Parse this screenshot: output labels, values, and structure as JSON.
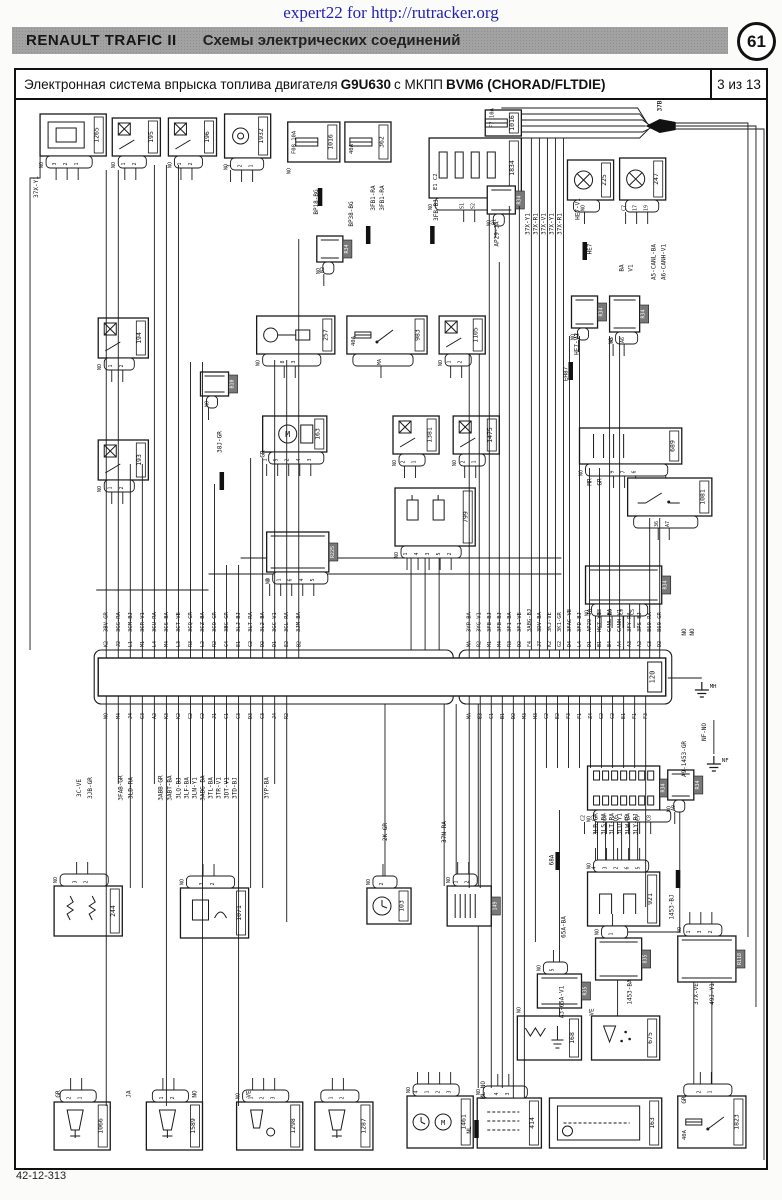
{
  "page": {
    "watermark": "expert22 for http://rutracker.org",
    "header": {
      "brand": "RENAULT  TRAFIC II",
      "title": "Схемы электрических соединений",
      "page_circle": "61"
    },
    "diagram_title": {
      "prefix": "Электронная система впрыска топлива двигателя",
      "engine": "G9U630",
      "middle": "с МКПП",
      "gearbox": "BVM6 (CHORAD/FLTDIE)",
      "page_of": "3 из 13"
    },
    "footer_code": "42-12-313"
  },
  "diagram": {
    "ecu": {
      "id": "120",
      "body": {
        "x": 98,
        "y": 656,
        "w": 566,
        "h": 38
      },
      "shrouds": [
        [
          94,
          648,
          358,
          54
        ],
        [
          458,
          648,
          212,
          54
        ]
      ],
      "label_box": {
        "x": 646,
        "y": 660,
        "w": 14,
        "h": 30
      },
      "top": {
        "x0": 106,
        "dx": 12,
        "pins": [
          "K2",
          "J2",
          "L1",
          "M1",
          "L4",
          "M4",
          "L3",
          "R3",
          "L2",
          "R2",
          "C4",
          "E1",
          "C2",
          "D2",
          "D1",
          "E2",
          "B2"
        ],
        "labels": [
          "3BV-GR",
          "3GG-RA",
          "3CM-BJ",
          "3CR-V1",
          "3CU-RA",
          "3CS-BA",
          "3CT-VE",
          "3CQ-GR",
          "3CZ-BA",
          "3CO-GR",
          "3BG-GR",
          "3LJ-BJ",
          "3LT-RA",
          "3L2-BA",
          "3GC-V1",
          "3CL-RA",
          "3JM-BA"
        ],
        "up": [
          168,
          168,
          462,
          462,
          163,
          163,
          163,
          360,
          360,
          482,
          563,
          563,
          456,
          456,
          358,
          358,
          237
        ]
      },
      "top2": {
        "x0": 468,
        "dx": 10,
        "pins": [
          "MA",
          "R2",
          "M1",
          "M4",
          "R3",
          "D2",
          "F4",
          "J7",
          "K2",
          "G2",
          "D4",
          "L4",
          "D1",
          "B1",
          "B4",
          "A4",
          "A3",
          "A2",
          "C3",
          "D2"
        ],
        "labels": [
          "3YP-BA",
          "3YG-V1",
          "3FB-BJ",
          "3FB-BJ",
          "3F1-BA",
          "3F1-VE",
          "3ABG-BJ",
          "3DV-BA",
          "3KJ-VE",
          "3K1-GR",
          "3FAC-VE",
          "3FD-BJ",
          "AP29-JA",
          "HK7-Y1",
          "CANL-BA",
          "CANH-V1",
          "3FY-RA",
          "3PS-BJ",
          "869-RA",
          "869-GR"
        ],
        "up": [
          352,
          352,
          212,
          260,
          204,
          204,
          648,
          648,
          648,
          648,
          334,
          334,
          466,
          466,
          334,
          334,
          602,
          602,
          516,
          516
        ]
      },
      "bot": {
        "x0": 106,
        "dx": 12,
        "pins": [
          "NO",
          "M4",
          "J4",
          "G3",
          "A2",
          "K3",
          "K2",
          "G2",
          "C2",
          "J1",
          "C1",
          "C3",
          "D3",
          "C3",
          "J4",
          "R2"
        ],
        "down": [
          1104,
          782,
          886,
          886,
          782,
          1104,
          782,
          782,
          1104,
          782,
          782,
          1104,
          886,
          886,
          782,
          920
        ]
      },
      "bot2": {
        "x0": 468,
        "dx": 11,
        "pins": [
          "MA",
          "E3",
          "C1",
          "B1",
          "D2",
          "M3",
          "H3",
          "C2",
          "E2",
          "F3",
          "F1",
          "Z4",
          "G2",
          "C2",
          "E1",
          "F1",
          "F3"
        ],
        "down": [
          886,
          886,
          1086,
          1086,
          1096,
          1096,
          940,
          766,
          766,
          766,
          766,
          766,
          766,
          766,
          766,
          766,
          905
        ]
      }
    },
    "components": [
      {
        "id": "1265",
        "x": 40,
        "y": 112,
        "w": 66,
        "h": 42,
        "ic": "sensorBlock",
        "pins": [
          "3",
          "2",
          "1"
        ],
        "no": true
      },
      {
        "id": "195",
        "x": 112,
        "y": 116,
        "w": 48,
        "h": 38,
        "ic": "relay",
        "pins": [
          "1",
          "2"
        ],
        "no": true
      },
      {
        "id": "196",
        "x": 168,
        "y": 116,
        "w": 48,
        "h": 38,
        "ic": "relay",
        "pins": [
          "1",
          "2"
        ],
        "no": true
      },
      {
        "id": "1932",
        "x": 224,
        "y": 112,
        "w": 46,
        "h": 44,
        "ic": "pump",
        "pins": [
          "3",
          "2",
          "1"
        ],
        "no": true
      },
      {
        "id": "1016",
        "x": 287,
        "y": 120,
        "w": 52,
        "h": 40,
        "ic": "fuse",
        "note": "F08 10A",
        "no": true
      },
      {
        "id": "362",
        "x": 344,
        "y": 120,
        "w": 46,
        "h": 40,
        "ic": "fuse",
        "note": "40A"
      },
      {
        "id": "1834",
        "x": 428,
        "y": 136,
        "w": 92,
        "h": 60,
        "ic": "fusebox",
        "pins": [
          "S1",
          "S2"
        ],
        "note": "E1 C2",
        "no": true
      },
      {
        "id": "1016",
        "x": 484,
        "y": 108,
        "w": 36,
        "h": 26,
        "ic": "fuse",
        "note": "F7 10A"
      },
      {
        "id": "225",
        "x": 566,
        "y": 158,
        "w": 46,
        "h": 40,
        "ic": "fan",
        "pins": [
          "NO"
        ]
      },
      {
        "id": "247",
        "x": 618,
        "y": 156,
        "w": 46,
        "h": 42,
        "ic": "fan",
        "pins": [
          "C7",
          "17",
          "19"
        ]
      },
      {
        "id": "R34",
        "x": 486,
        "y": 184,
        "w": 28,
        "h": 28,
        "ic": "inlineV",
        "pins": [
          "B1"
        ],
        "no": true
      },
      {
        "id": "R34",
        "x": 316,
        "y": 234,
        "w": 26,
        "h": 26,
        "ic": "inlineV",
        "pins": [
          "B2"
        ],
        "no": true
      },
      {
        "id": "R34",
        "x": 570,
        "y": 294,
        "w": 26,
        "h": 32,
        "ic": "inlineV",
        "pins": [
          "A7"
        ],
        "no": true
      },
      {
        "id": "R34",
        "x": 608,
        "y": 294,
        "w": 30,
        "h": 36,
        "ic": "inlineV",
        "pins": [
          "A5",
          "A6"
        ],
        "no": true
      },
      {
        "id": "194",
        "x": 98,
        "y": 316,
        "w": 50,
        "h": 40,
        "ic": "relay",
        "pins": [
          "1",
          "2"
        ],
        "no": true
      },
      {
        "id": "193",
        "x": 98,
        "y": 438,
        "w": 50,
        "h": 40,
        "ic": "relay",
        "pins": [
          "1",
          "2"
        ],
        "no": true
      },
      {
        "id": "257",
        "x": 256,
        "y": 314,
        "w": 78,
        "h": 38,
        "ic": "glow",
        "pins": [
          "8",
          "3"
        ],
        "no": true
      },
      {
        "id": "983",
        "x": 346,
        "y": 314,
        "w": 80,
        "h": 38,
        "ic": "fuseSwitch",
        "note": "40A",
        "pins": [
          "MA"
        ]
      },
      {
        "id": "1105",
        "x": 438,
        "y": 314,
        "w": 46,
        "h": 38,
        "ic": "relay",
        "pins": [
          "1",
          "2"
        ],
        "no": true
      },
      {
        "id": "B10",
        "x": 200,
        "y": 370,
        "w": 28,
        "h": 24,
        "ic": "inlineV",
        "pins": [
          "NO"
        ]
      },
      {
        "id": "163",
        "x": 262,
        "y": 414,
        "w": 64,
        "h": 36,
        "ic": "starter",
        "pins": [
          "1",
          "5",
          "2",
          "4",
          "3"
        ]
      },
      {
        "id": "1381",
        "x": 392,
        "y": 414,
        "w": 46,
        "h": 38,
        "ic": "relay",
        "pins": [
          "2",
          "1"
        ],
        "no": true
      },
      {
        "id": "1475",
        "x": 452,
        "y": 414,
        "w": 46,
        "h": 38,
        "ic": "relay",
        "pins": [
          "2",
          "1"
        ],
        "no": true
      },
      {
        "id": "689",
        "x": 578,
        "y": 426,
        "w": 102,
        "h": 36,
        "ic": "comb",
        "pins": [
          "9",
          "7",
          "6"
        ],
        "no": true
      },
      {
        "id": "1081",
        "x": 626,
        "y": 476,
        "w": 84,
        "h": 38,
        "ic": "switch",
        "pins": [
          "36",
          "A7"
        ]
      },
      {
        "id": "799",
        "x": 394,
        "y": 486,
        "w": 80,
        "h": 58,
        "ic": "sol2",
        "pins": [
          "1",
          "4",
          "3",
          "5",
          "2"
        ],
        "no": true
      },
      {
        "id": "R225",
        "x": 266,
        "y": 530,
        "w": 62,
        "h": 40,
        "ic": "inline",
        "pins": [
          "3",
          "1",
          "6",
          "4",
          "5"
        ],
        "no": true
      },
      {
        "id": "R34",
        "x": 584,
        "y": 564,
        "w": 76,
        "h": 38,
        "ic": "inline",
        "pins": [
          "B8",
          "B9",
          "C9",
          "C5"
        ],
        "no": true
      },
      {
        "id": "R34",
        "x": 586,
        "y": 764,
        "w": 72,
        "h": 44,
        "ic": "gridConn",
        "pins": [
          "C2",
          "C3",
          "C4",
          "D5",
          "C5",
          "C7",
          "C8"
        ],
        "no": true
      },
      {
        "id": "R34",
        "x": 666,
        "y": 768,
        "w": 26,
        "h": 30,
        "ic": "inlineV",
        "pins": [
          "A9"
        ],
        "no": true
      },
      {
        "id": "244",
        "x": 54,
        "y": 884,
        "w": 68,
        "h": 50,
        "ic": "res2",
        "pins": [
          "3",
          "2"
        ],
        "no": true,
        "pt": true
      },
      {
        "id": "1071",
        "x": 180,
        "y": 886,
        "w": 68,
        "h": 50,
        "ic": "sensor1",
        "pins": [
          "3",
          "2"
        ],
        "no": true,
        "pt": true
      },
      {
        "id": "103",
        "x": 366,
        "y": 886,
        "w": 44,
        "h": 36,
        "ic": "clock",
        "pins": [
          "2"
        ],
        "no": true,
        "pt": true
      },
      {
        "id": "149",
        "x": 446,
        "y": 884,
        "w": 44,
        "h": 40,
        "ic": "plug",
        "pins": [
          "1",
          "2"
        ],
        "no": true,
        "pt": true
      },
      {
        "id": "921",
        "x": 586,
        "y": 870,
        "w": 72,
        "h": 54,
        "ic": "coil2",
        "pins": [
          "4",
          "3",
          "2",
          "6",
          "5"
        ],
        "no": true,
        "pt": true
      },
      {
        "id": "R35",
        "x": 536,
        "y": 972,
        "w": 44,
        "h": 34,
        "ic": "inline",
        "pins": [
          "5"
        ],
        "no": true,
        "pt": true
      },
      {
        "id": "835",
        "x": 594,
        "y": 936,
        "w": 46,
        "h": 42,
        "ic": "inlineV",
        "pins": [
          "1"
        ],
        "no": true,
        "pt": true
      },
      {
        "id": "R118",
        "x": 676,
        "y": 934,
        "w": 58,
        "h": 46,
        "ic": "inline",
        "pins": [
          "1",
          "3",
          "2"
        ],
        "no": true,
        "pt": true
      },
      {
        "id": "168",
        "x": 516,
        "y": 1014,
        "w": 64,
        "h": 44,
        "ic": "heater",
        "pins": [],
        "no": true,
        "pt": true
      },
      {
        "id": "675",
        "x": 590,
        "y": 1014,
        "w": 68,
        "h": 44,
        "ic": "nozzle",
        "pins": [],
        "pt": true
      },
      {
        "id": "1461",
        "x": 406,
        "y": 1094,
        "w": 66,
        "h": 52,
        "ic": "clockMotor",
        "pins": [
          "4",
          "1",
          "2",
          "3"
        ],
        "no": true,
        "pt": true
      },
      {
        "id": "414",
        "x": 476,
        "y": 1096,
        "w": 64,
        "h": 50,
        "ic": "grid",
        "pins": [
          "4",
          "3"
        ],
        "no": true,
        "pt": true
      },
      {
        "id": "163",
        "x": 548,
        "y": 1096,
        "w": 112,
        "h": 50,
        "ic": "tank",
        "pins": [],
        "pt": true
      },
      {
        "id": "1823",
        "x": 676,
        "y": 1094,
        "w": 68,
        "h": 52,
        "ic": "fuseSwitch",
        "note": "40A",
        "pins": [
          "2",
          "1"
        ],
        "pt": true
      },
      {
        "id": "1066",
        "x": 54,
        "y": 1100,
        "w": 56,
        "h": 48,
        "ic": "inj",
        "pins": [
          "2",
          "1"
        ],
        "pt": true
      },
      {
        "id": "1589",
        "x": 146,
        "y": 1100,
        "w": 56,
        "h": 48,
        "ic": "inj",
        "pins": [
          "1",
          "2"
        ],
        "pt": true
      },
      {
        "id": "1298",
        "x": 236,
        "y": 1100,
        "w": 66,
        "h": 48,
        "ic": "inj2",
        "pins": [
          "1",
          "2",
          "3"
        ],
        "no": true,
        "pt": true
      },
      {
        "id": "1287",
        "x": 314,
        "y": 1100,
        "w": 58,
        "h": 48,
        "ic": "inj",
        "pins": [
          "1",
          "2"
        ],
        "pt": true
      }
    ],
    "wire_labels": [
      [
        "37X-Y1",
        38,
        185
      ],
      [
        "BP18-BG",
        317,
        200
      ],
      [
        "BP38-BG",
        352,
        212
      ],
      [
        "3FB1-RA",
        374,
        196
      ],
      [
        "3FB1-RA",
        383,
        196
      ],
      [
        "3FB-BJ",
        437,
        208
      ],
      [
        "AP29-JA",
        497,
        232
      ],
      [
        "HE7-V1",
        578,
        207
      ],
      [
        "BA",
        622,
        266
      ],
      [
        "V1",
        631,
        266
      ],
      [
        "37X-Y1",
        528,
        222
      ],
      [
        "37X-R1",
        536,
        222
      ],
      [
        "37X-V1",
        544,
        222
      ],
      [
        "37X-Y1",
        552,
        222
      ],
      [
        "37X-R1",
        560,
        222
      ],
      [
        "A5-CANL-BA",
        654,
        260
      ],
      [
        "A6-CANH-V1",
        664,
        260
      ],
      [
        "HE7-V1",
        577,
        342
      ],
      [
        "EH87",
        566,
        372
      ],
      [
        "37B",
        660,
        104
      ],
      [
        "HE7",
        590,
        247
      ],
      [
        "38J-GR",
        221,
        440
      ],
      [
        "GR",
        264,
        452
      ],
      [
        "MR",
        590,
        480
      ],
      [
        "GR",
        600,
        480
      ],
      [
        "A9-1453-GR",
        684,
        757
      ],
      [
        "NF-NO",
        704,
        730
      ],
      [
        "NO",
        684,
        630
      ],
      [
        "NO",
        692,
        630
      ],
      [
        "3C-VE",
        81,
        786
      ],
      [
        "3JB-GR",
        92,
        786
      ],
      [
        "3FAB-GR",
        122,
        786
      ],
      [
        "3LD-RA",
        132,
        786
      ],
      [
        "3ABB-GR",
        162,
        786
      ],
      [
        "3ABT-BA",
        171,
        786
      ],
      [
        "3LQ-BJ",
        180,
        786
      ],
      [
        "3LF-BA",
        188,
        786
      ],
      [
        "3LN-Y1",
        196,
        786
      ],
      [
        "3ABG-BA",
        204,
        786
      ],
      [
        "3TL-BA",
        212,
        786
      ],
      [
        "3TR-V1",
        220,
        786
      ],
      [
        "3DT-V1",
        228,
        786
      ],
      [
        "3TD-BJ",
        236,
        786
      ],
      [
        "3YP-BA",
        268,
        786
      ],
      [
        "2K-GR",
        386,
        830
      ],
      [
        "37N-RA",
        445,
        830
      ],
      [
        "3LR-GR",
        596,
        822
      ],
      [
        "3LS-BA",
        604,
        822
      ],
      [
        "3LT-RA",
        612,
        822
      ],
      [
        "3LU-Y1",
        620,
        822
      ],
      [
        "3LW-BA",
        628,
        822
      ],
      [
        "3LY-BJ",
        636,
        822
      ],
      [
        "68A",
        552,
        858
      ],
      [
        "1453-BJ",
        672,
        905
      ],
      [
        "65A-BA",
        564,
        925
      ],
      [
        "A3-65A-V1",
        562,
        1000
      ],
      [
        "1453-BA",
        630,
        990
      ],
      [
        "37X-VE",
        696,
        992
      ],
      [
        "49J-Y1",
        712,
        992
      ],
      [
        "VE",
        592,
        1010
      ],
      [
        "GR",
        684,
        1098
      ],
      [
        "ML-NO",
        484,
        1088
      ],
      [
        "NL",
        470,
        1128
      ],
      [
        "GR",
        60,
        1092
      ],
      [
        "JA",
        130,
        1092
      ],
      [
        "NO",
        196,
        1092
      ],
      [
        "VE",
        250,
        1092
      ]
    ],
    "splices": [
      [
        319,
        186
      ],
      [
        367,
        224
      ],
      [
        431,
        224
      ],
      [
        583,
        240
      ],
      [
        569,
        360
      ],
      [
        221,
        470
      ],
      [
        556,
        850
      ],
      [
        475,
        1118
      ],
      [
        676,
        868
      ]
    ],
    "grounds": [
      [
        700,
        680,
        "MH"
      ],
      [
        712,
        754,
        "NF"
      ]
    ],
    "bundle_label": "37B"
  }
}
